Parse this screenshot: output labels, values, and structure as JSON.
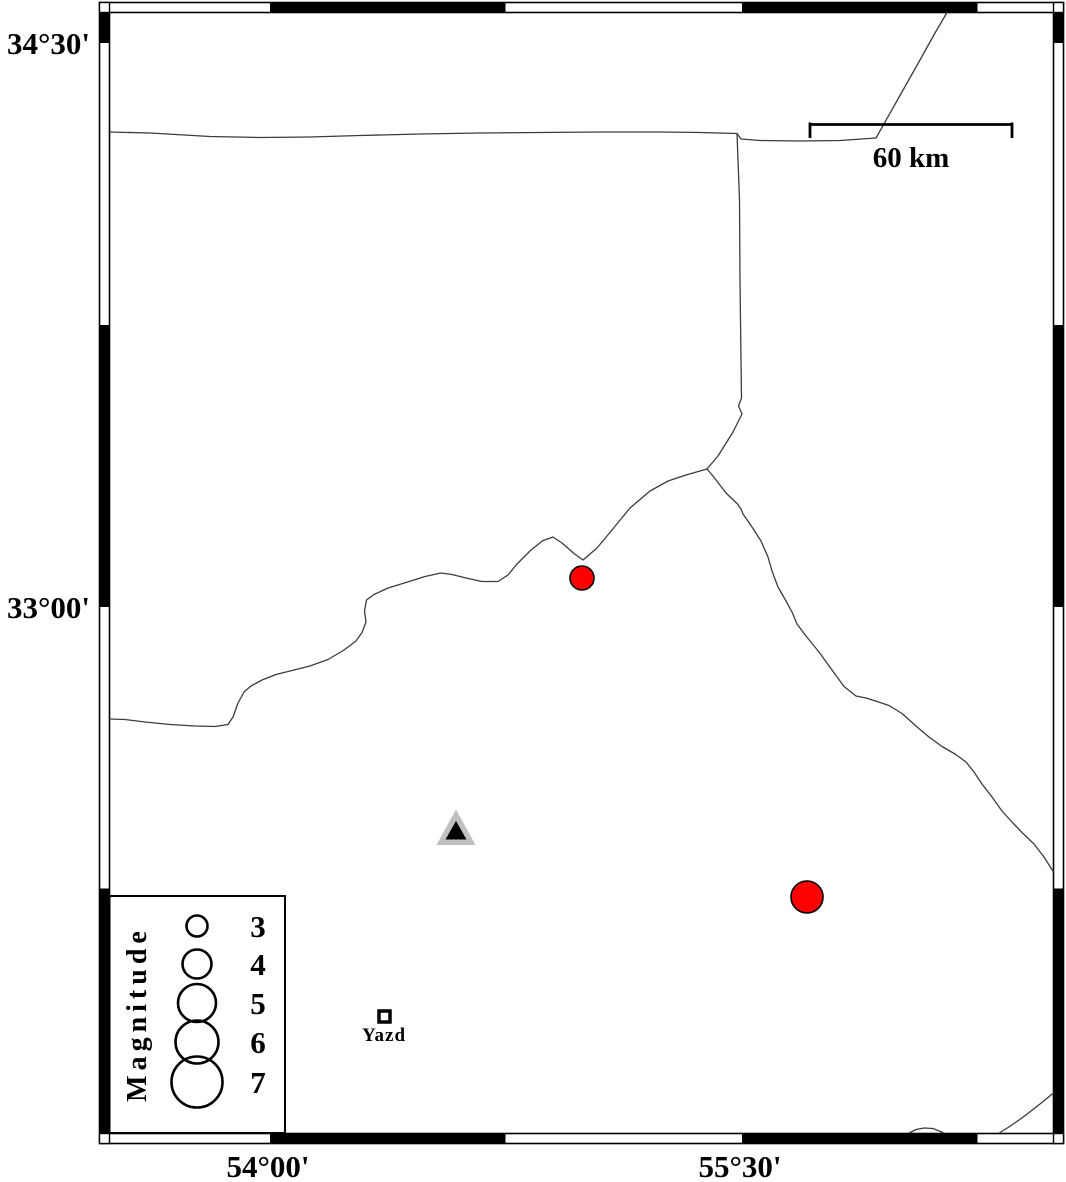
{
  "map": {
    "axis_labels": {
      "lat_top": "34°30'",
      "lat_mid": "33°00'",
      "lon_left": "54°00'",
      "lon_right": "55°30'"
    },
    "scale_bar": {
      "label": "60 km"
    },
    "legend": {
      "title": "Magnitude",
      "entries": [
        {
          "label": "3",
          "radius_px": 10.5
        },
        {
          "label": "4",
          "radius_px": 14.5
        },
        {
          "label": "5",
          "radius_px": 19
        },
        {
          "label": "6",
          "radius_px": 21.5
        },
        {
          "label": "7",
          "radius_px": 25.5
        }
      ]
    },
    "markers": {
      "earthquakes": [
        {
          "x_px": 582,
          "y_px": 578,
          "radius_px": 12,
          "color": "#ff0000"
        },
        {
          "x_px": 807,
          "y_px": 897,
          "radius_px": 16,
          "color": "#ff0000"
        }
      ],
      "station": {
        "x_px": 456,
        "y_px": 828,
        "fill": "#c0c0c0"
      },
      "city": {
        "name": "Yazd"
      }
    },
    "colors": {
      "earthquake_red": "#ff0000",
      "station_gray": "#c0c0c0",
      "boundary_line": "#3c3c3c"
    }
  }
}
